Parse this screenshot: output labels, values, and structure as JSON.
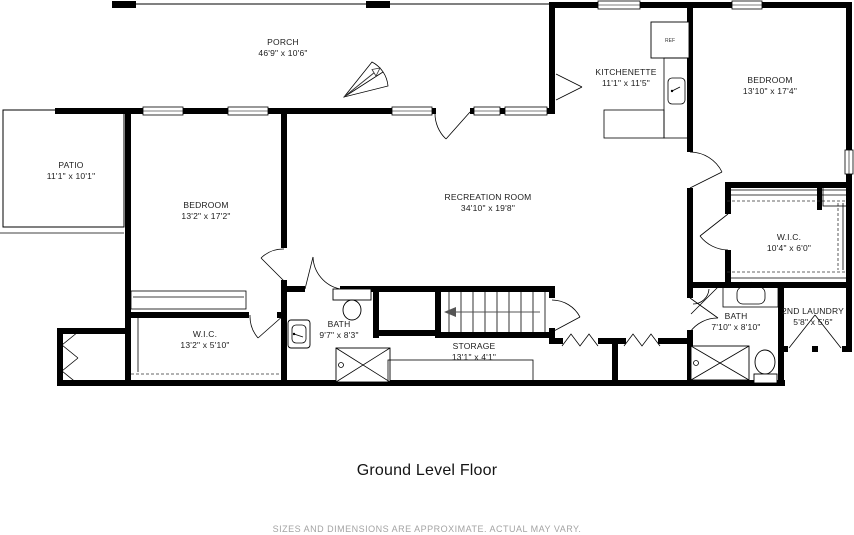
{
  "title": "Ground Level Floor",
  "disclaimer": "SIZES AND DIMENSIONS ARE APPROXIMATE. ACTUAL MAY VARY.",
  "rooms": {
    "porch": {
      "name": "PORCH",
      "dims": "46'9\" x 10'6\""
    },
    "patio": {
      "name": "PATIO",
      "dims": "11'1\" x 10'1\""
    },
    "bedroom_left": {
      "name": "BEDROOM",
      "dims": "13'2\" x 17'2\""
    },
    "recreation": {
      "name": "RECREATION ROOM",
      "dims": "34'10\" x 19'8\""
    },
    "kitchenette": {
      "name": "KITCHENETTE",
      "dims": "11'1\" x 11'5\""
    },
    "bedroom_right": {
      "name": "BEDROOM",
      "dims": "13'10\" x 17'4\""
    },
    "wic_right": {
      "name": "W.I.C.",
      "dims": "10'4\" x 6'0\""
    },
    "bath_right": {
      "name": "BATH",
      "dims": "7'10\" x 8'10\""
    },
    "laundry": {
      "name": "2ND LAUNDRY",
      "dims": "5'8\" x 5'6\""
    },
    "wic_left": {
      "name": "W.I.C.",
      "dims": "13'2\" x 5'10\""
    },
    "bath_left": {
      "name": "BATH",
      "dims": "9'7\" x 8'3\""
    },
    "storage": {
      "name": "STORAGE",
      "dims": "13'1\" x 4'1\""
    }
  },
  "fixtures": {
    "refrigerator": "REF"
  },
  "colors": {
    "wall": "#000000",
    "label": "#1c1c1c",
    "disclaimer": "#a3a3a3"
  }
}
